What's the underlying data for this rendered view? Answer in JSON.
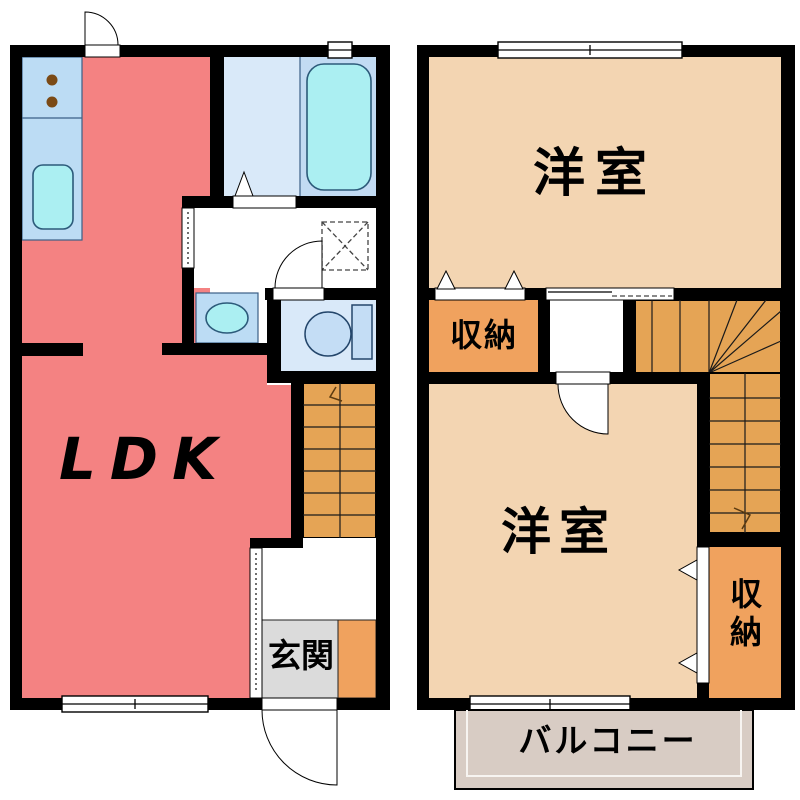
{
  "floor1": {
    "ldk_label": "LDK",
    "genkan_label": "玄関"
  },
  "floor2": {
    "bedroom_upper_label": "洋室",
    "bedroom_lower_label": "洋室",
    "closet_upper_label": "収納",
    "closet_lower_label": "収納",
    "balcony_label": "バルコニー"
  },
  "colors": {
    "ldk": "#f48282",
    "bedroom": "#f3d5b2",
    "stairs": "#e5a455",
    "closet": "#f0a25e",
    "genkan": "#dbdbdb",
    "balcony": "#d8ccc4",
    "kitchen_counter": "#bcdcf4",
    "bath_floor": "#d9e9f9",
    "bath_tub_zone": "#c2dbf3",
    "water_fixture": "#abeff2",
    "toilet_fixture": "#c4ddf5",
    "wall": "#000000",
    "stove_burner": "#7b4a15"
  }
}
